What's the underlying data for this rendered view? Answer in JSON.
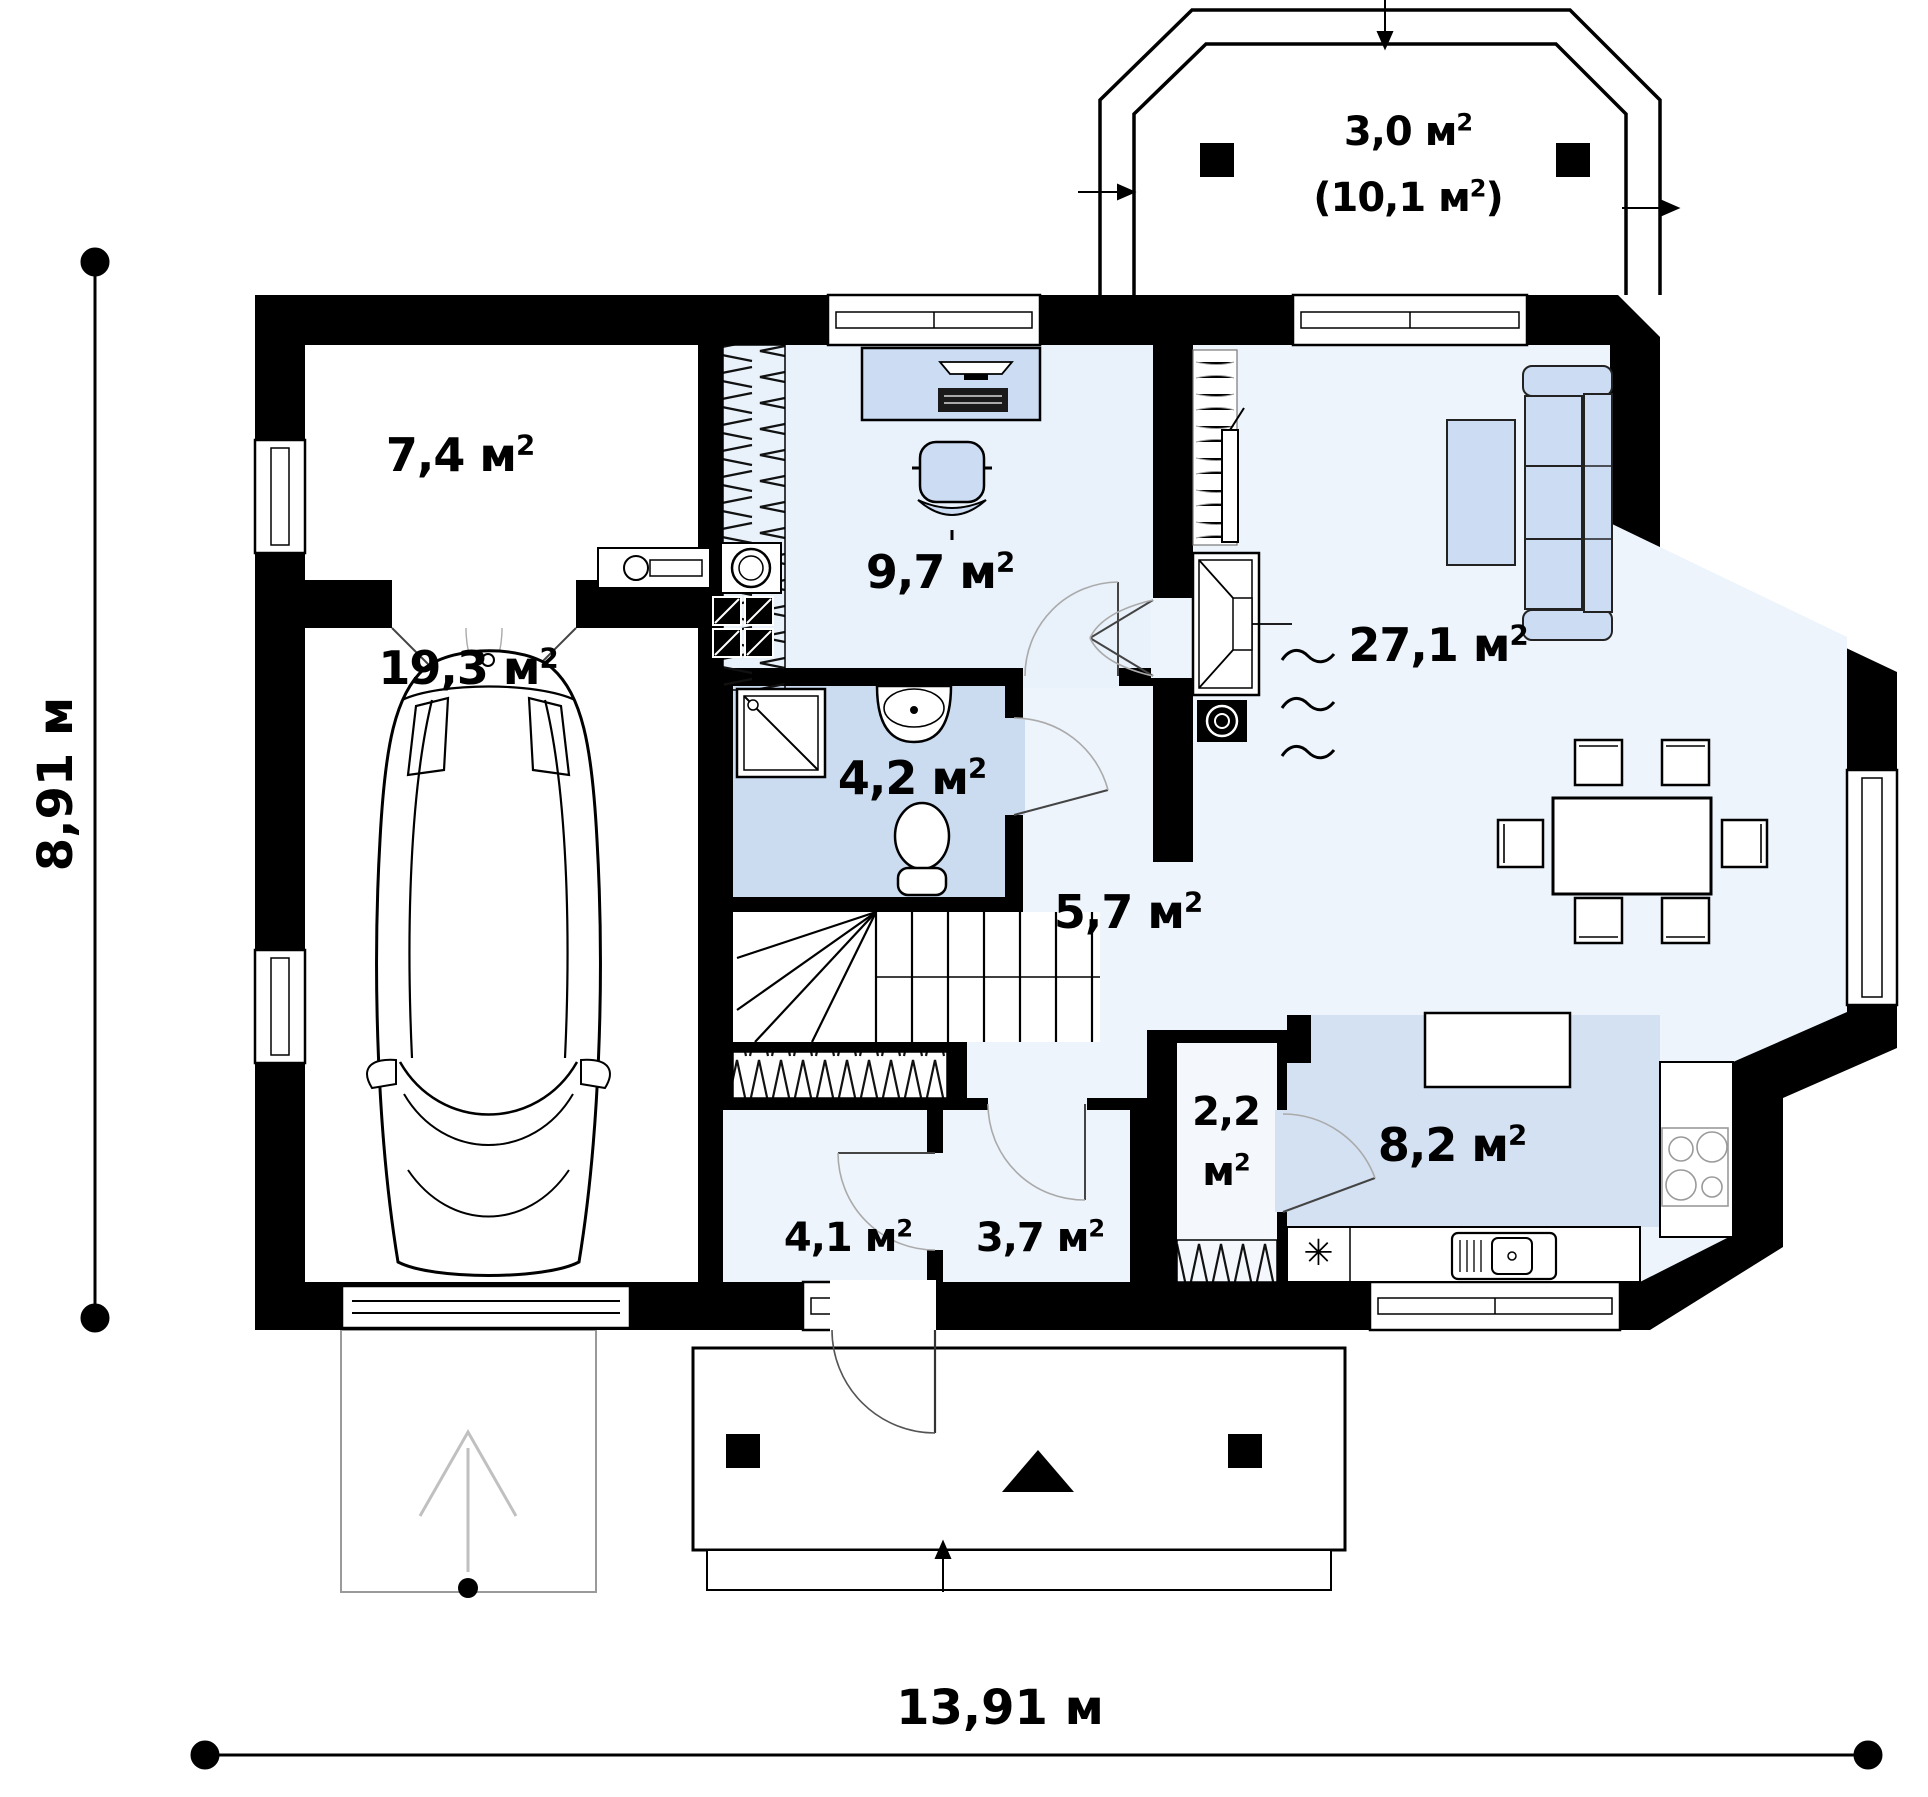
{
  "colors": {
    "wall": "#000000",
    "floor-light": "#edf4fc",
    "floor-office": "#e9f1fb",
    "floor-bath": "#ccdcf0",
    "floor-kitchen": "#d4e1f3",
    "furniture": "#ccdcf2",
    "outline-gray": "#9a9a9a"
  },
  "dimensions": {
    "width": "13,91 м",
    "height": "8,91 м"
  },
  "rooms": {
    "storage": "7,4 м²",
    "garage": "19,3 м²",
    "office": "9,7 м²",
    "bathroom": "4,2 м²",
    "hall": "5,7 м²",
    "living": "27,1 м²",
    "wardrobe_room": "4,1 м²",
    "vestibule": "3,7 м²",
    "pantry_line1": "2,2",
    "pantry_line2": "м²",
    "kitchen": "8,2 м²",
    "terrace": "3,0 м²",
    "terrace_total": "(10,1 м²)"
  },
  "symbols": {
    "stove_mark": "✳"
  }
}
